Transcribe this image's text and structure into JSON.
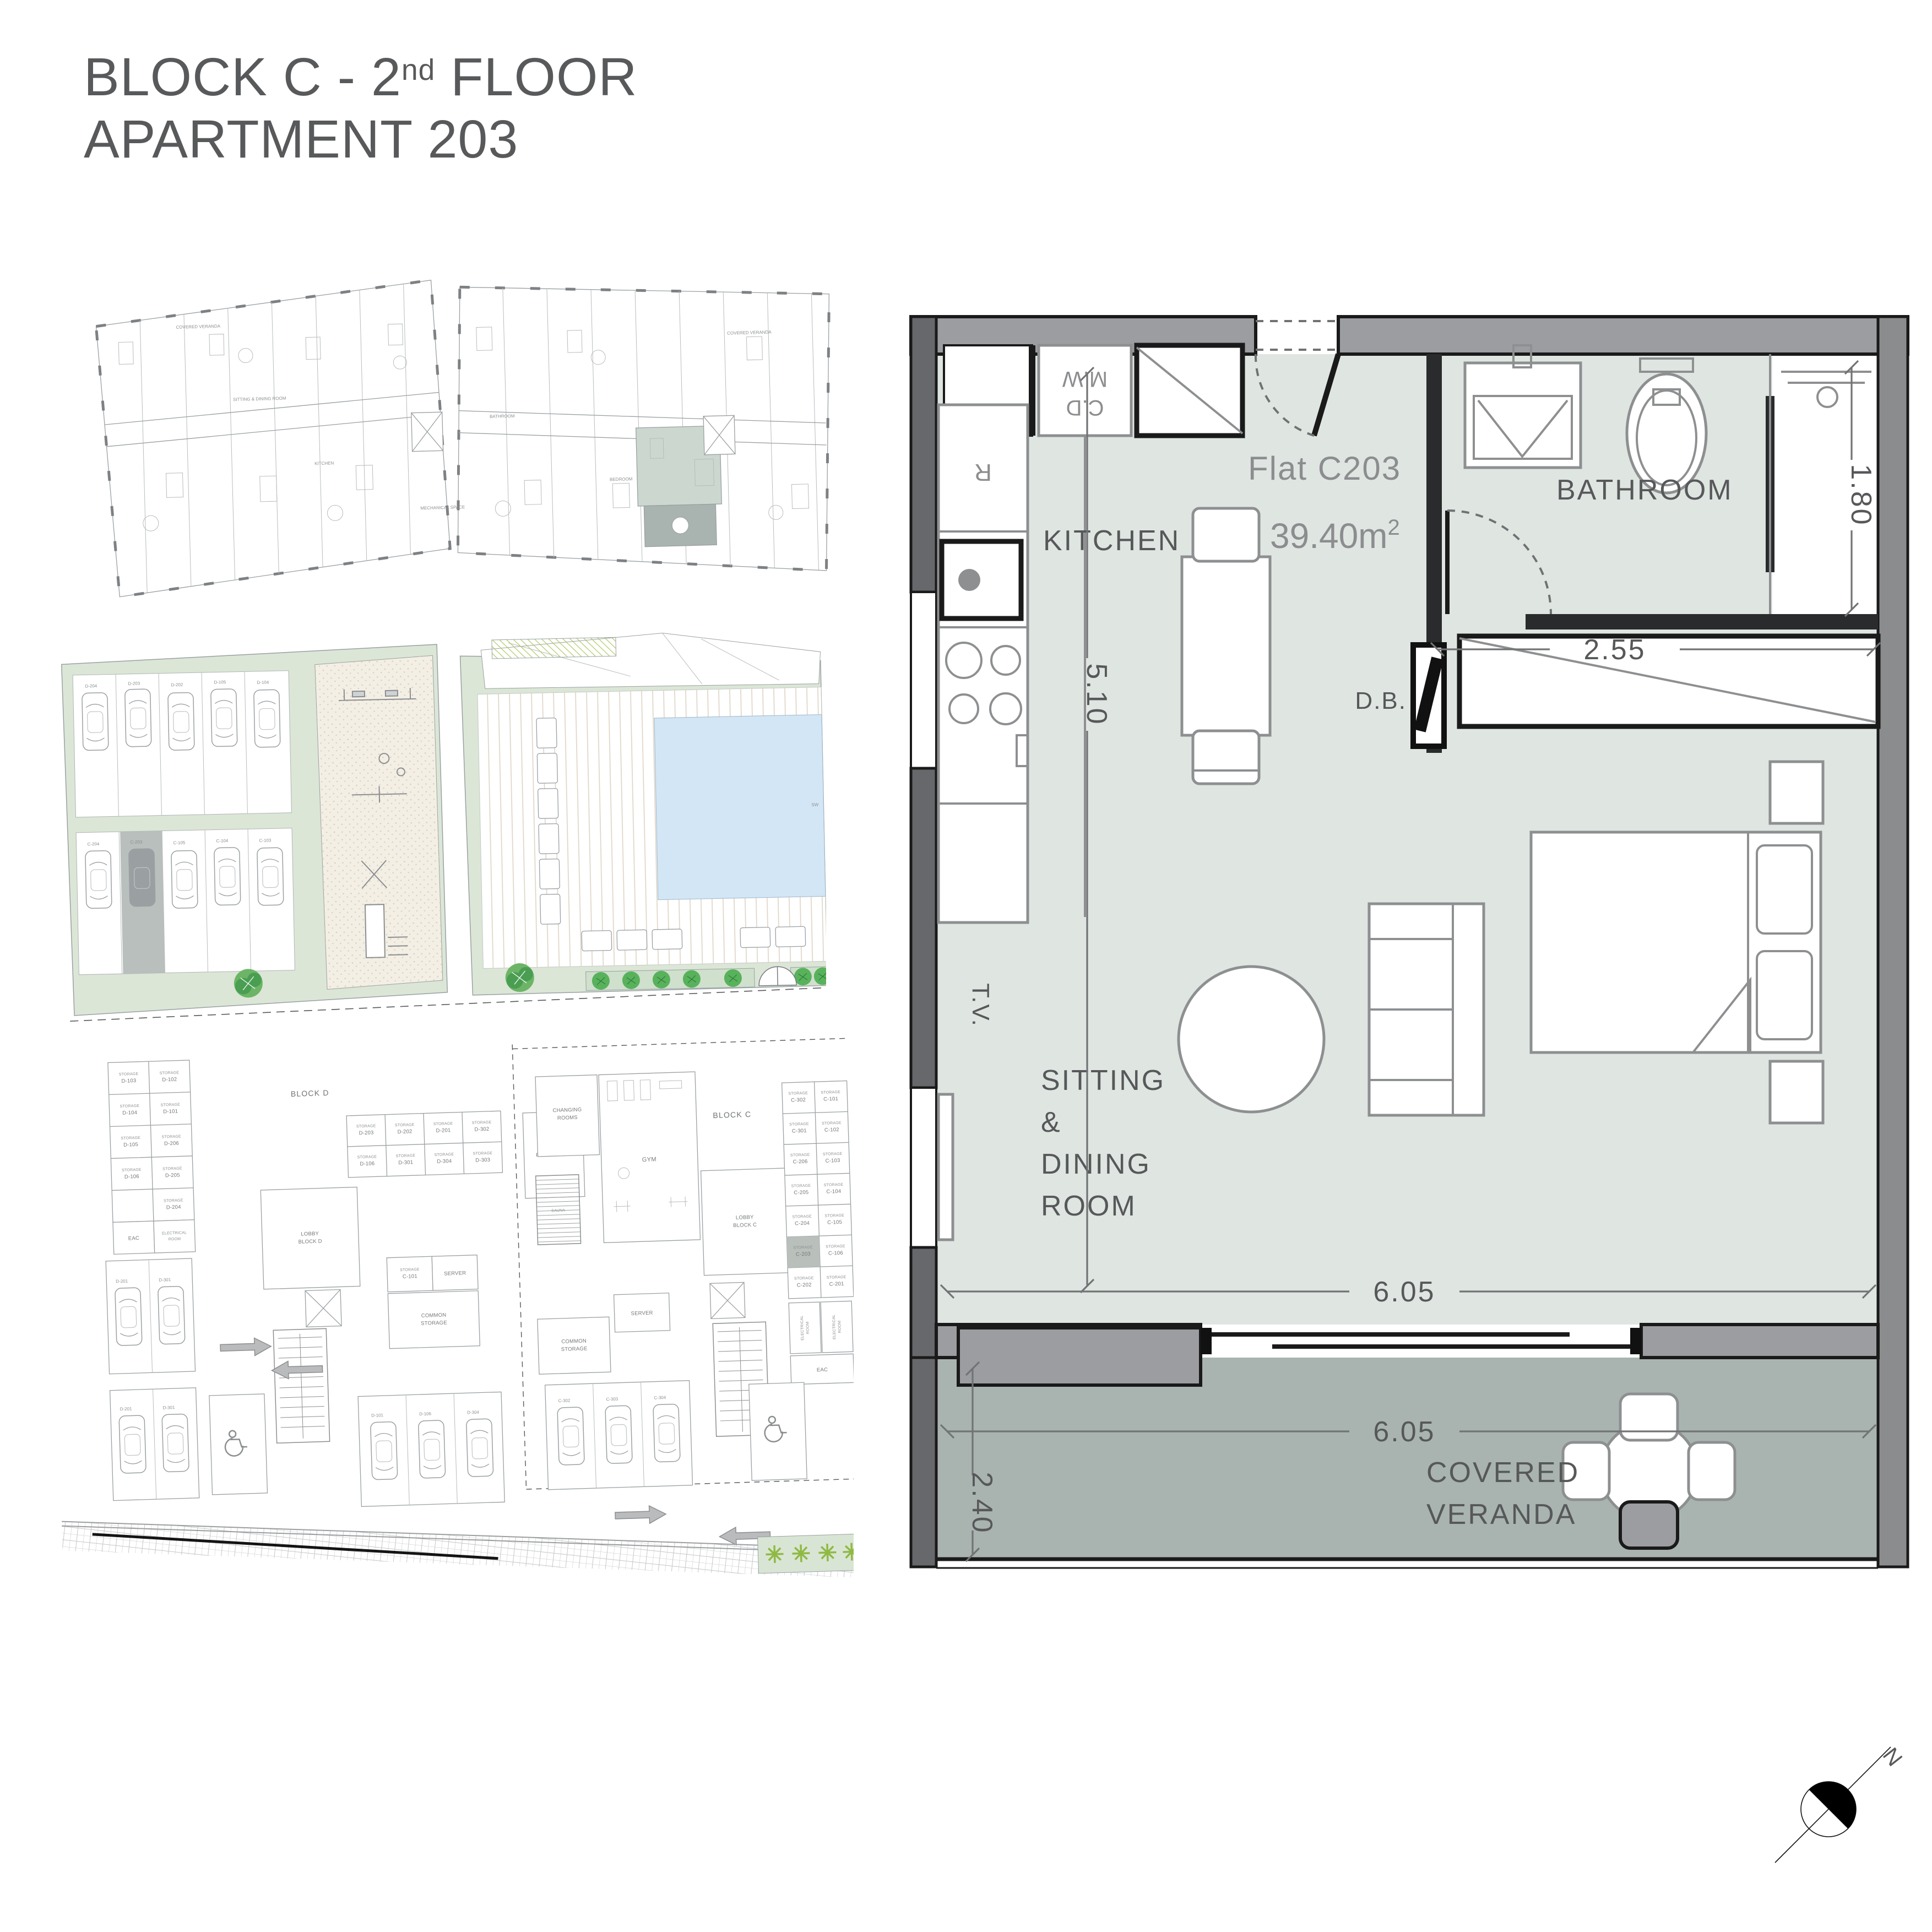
{
  "title": {
    "block_line_prefix": "BLOCK C - 2",
    "block_line_sup": "nd",
    "block_line_suffix": " FLOOR",
    "apartment_line": "APARTMENT 203"
  },
  "main_plan": {
    "flat_label": "Flat C203",
    "area_label": "39.40m",
    "area_sup": "2",
    "room_labels": {
      "kitchen": "KITCHEN",
      "bathroom": "BATHROOM",
      "sitting_line1": "SITTING",
      "sitting_line2": "&",
      "sitting_line3": "DINING",
      "sitting_line4": "ROOM",
      "veranda_line1": "COVERED",
      "veranda_line2": "VERANDA"
    },
    "fixture_labels": {
      "microwave": "M.W",
      "cooker_dryer": "C.D",
      "fridge": "R",
      "distribution_board": "D.B.",
      "tv": "T.V."
    },
    "dimensions": {
      "room_width": "6.05",
      "veranda_width": "6.05",
      "room_depth": "5.10",
      "veranda_depth": "2.40",
      "bathroom_width": "2.55",
      "shower_depth": "1.80"
    },
    "north_label": "N"
  },
  "site_plan": {
    "parking_labels_top": [
      "D-204",
      "D-203",
      "D-202",
      "D-105",
      "D-104"
    ],
    "parking_labels_bottom": [
      "C-204",
      "C-203",
      "C-105",
      "C-104",
      "C-103"
    ],
    "pool_label": "SW"
  },
  "basement_plan": {
    "block_d": "BLOCK D",
    "block_c": "BLOCK C",
    "lobby_word": "LOBBY",
    "lobby_d_line2": "BLOCK D",
    "lobby_c_line2": "BLOCK C",
    "storage_word": "STORAGE",
    "grid_d_left": [
      "D-103",
      "D-102",
      "D-104",
      "D-101",
      "D-105",
      "D-206",
      "D-106",
      "D-205",
      "D-204"
    ],
    "grid_d_mid": [
      "D-203",
      "D-202",
      "D-201",
      "D-302",
      "D-106",
      "D-301",
      "D-304",
      "D-303"
    ],
    "grid_c": [
      "C-302",
      "C-101",
      "C-301",
      "C-102",
      "C-206",
      "C-103",
      "C-205",
      "C-104",
      "C-204",
      "C-105",
      "C-203",
      "C-106",
      "C-202",
      "C-201"
    ],
    "rooms": {
      "eac": "EAC",
      "electrical_line1": "ELECTRICAL",
      "electrical_line2": "ROOM",
      "plant_line1": "PLANT ROOM",
      "changing_line1": "CHANGING",
      "changing_line2": "ROOMS",
      "sauna": "SAUNA",
      "gym": "GYM",
      "server": "SERVER",
      "common_line1": "COMMON",
      "common_line2": "STORAGE",
      "storage_c101": "C-101"
    },
    "car_labels_d": [
      "D-201",
      "D-301",
      "D-201",
      "D-301",
      "D-101",
      "D-106",
      "D-304"
    ],
    "car_labels_c": [
      "C-302",
      "C-303",
      "C-304"
    ]
  },
  "thumb_plan": {
    "labels": [
      "COVERED VERANDA",
      "COVERED VERANDA",
      "SITTING & DINING ROOM",
      "KITCHEN",
      "BATHROOM",
      "BEDROOM",
      "MECHANICAL SPACE"
    ]
  },
  "colors": {
    "floor": "#dfe5e1",
    "veranda_floor": "#a9b4b0",
    "site_green": "#dbe6d6",
    "pool_blue": "#d3e6f5",
    "highlight_unit_green": "#ccd8cf",
    "highlight_storage_gray": "#b9c0bc",
    "text_gray": "#58595b"
  }
}
